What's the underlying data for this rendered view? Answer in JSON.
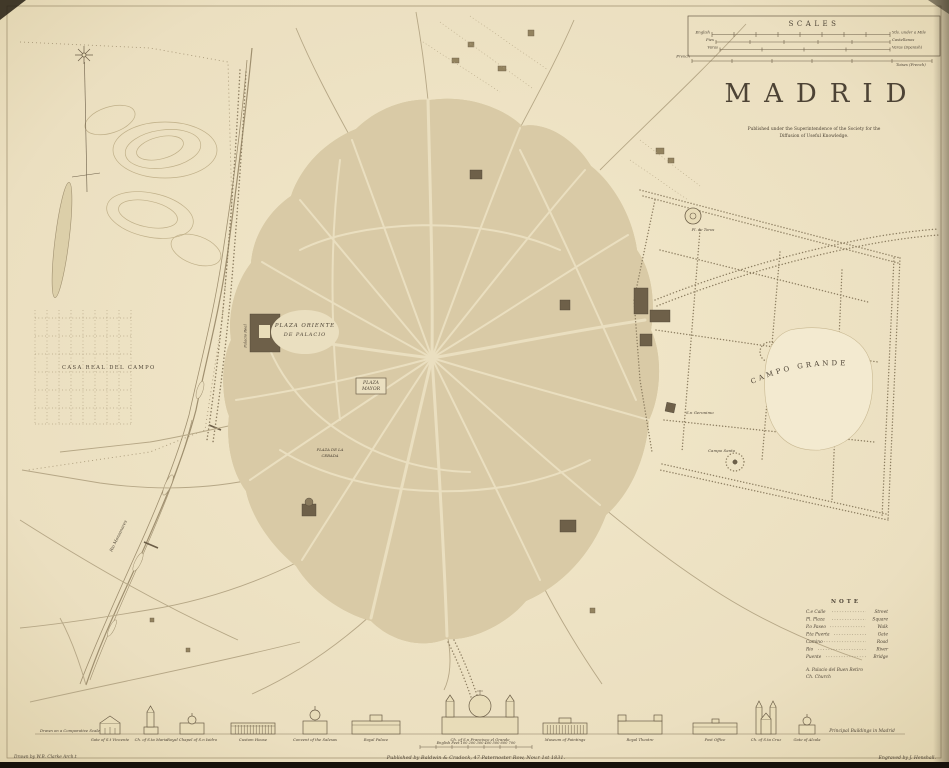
{
  "title": {
    "text": "MADRID",
    "subtitle_line1": "Published under the Superintendence of the Society for the",
    "subtitle_line2": "Diffusion of Useful Knowledge."
  },
  "scales": {
    "title": "SCALES",
    "rows": [
      {
        "left": "English",
        "right": "Yds. under a Mile"
      },
      {
        "left": "Pies",
        "right": "Castellanos"
      },
      {
        "left": "Varas",
        "right": "Varas (Spanish)"
      },
      {
        "left": "French",
        "right": "Toises (French)"
      }
    ]
  },
  "note": {
    "title": "NOTE",
    "rows": [
      {
        "abbr": "C.e Calle",
        "meaning": "Street"
      },
      {
        "abbr": "Pl. Plaza",
        "meaning": "Square"
      },
      {
        "abbr": "P.o Paseo",
        "meaning": "Walk"
      },
      {
        "abbr": "P.ta Puerta",
        "meaning": "Gate"
      },
      {
        "abbr": "Camino",
        "meaning": "Road"
      },
      {
        "abbr": "Rio",
        "meaning": "River"
      },
      {
        "abbr": "Puente",
        "meaning": "Bridge"
      }
    ],
    "extra_line1": "A. Palacio del Buen Retiro",
    "extra_line2": "Ch. Church"
  },
  "map_labels": {
    "casa_real_del_campo": "CASA REAL DEL CAMPO",
    "plaza_oriente_line1": "PLAZA ORIENTE",
    "plaza_oriente_line2": "DE PALACIO",
    "palacio_real": "Palacio Real",
    "plaza_mayor_line1": "PLAZA",
    "plaza_mayor_line2": "MAYOR",
    "plaza_cebada_line1": "PLAZA DE LA",
    "plaza_cebada_line2": "CEBADA",
    "campo_grande": "CAMPO GRANDE",
    "san_geronimo": "S.n Geronimo",
    "campo_santo": "Campo Santo",
    "plaza_de_toros": "Pl. de Toros",
    "rio_manzanares": "Rio Manzanares"
  },
  "frieze": {
    "intro_note": "Drawn on a Comparative Scale",
    "end_label": "Principal Buildings in Madrid",
    "scale_text": "English Feet   100    200    300    400    500    600    700",
    "buildings": [
      {
        "caption": "Gate of S.t Vincente"
      },
      {
        "caption": "Ch. of S.ta Maria"
      },
      {
        "caption": "Royal Chapel of S.n Isidro"
      },
      {
        "caption": "Custom House"
      },
      {
        "caption": "Convent of the Salesas"
      },
      {
        "caption": "Royal Palace"
      },
      {
        "caption": "Ch. of S.n Francisco el Grande"
      },
      {
        "caption": "Museum of Paintings"
      },
      {
        "caption": "Royal Theatre"
      },
      {
        "caption": "Post Office"
      },
      {
        "caption": "Ch. of S.ta Cruz"
      },
      {
        "caption": "Gate of Alcala"
      }
    ]
  },
  "credits": {
    "imprint": "Published by Baldwin & Cradock, 47 Paternoster Row, Nov.r 1st 1831.",
    "drawn_by": "Drawn by W.B. Clarke Arch.t",
    "engraved_by": "Engraved by J. Henshall."
  }
}
